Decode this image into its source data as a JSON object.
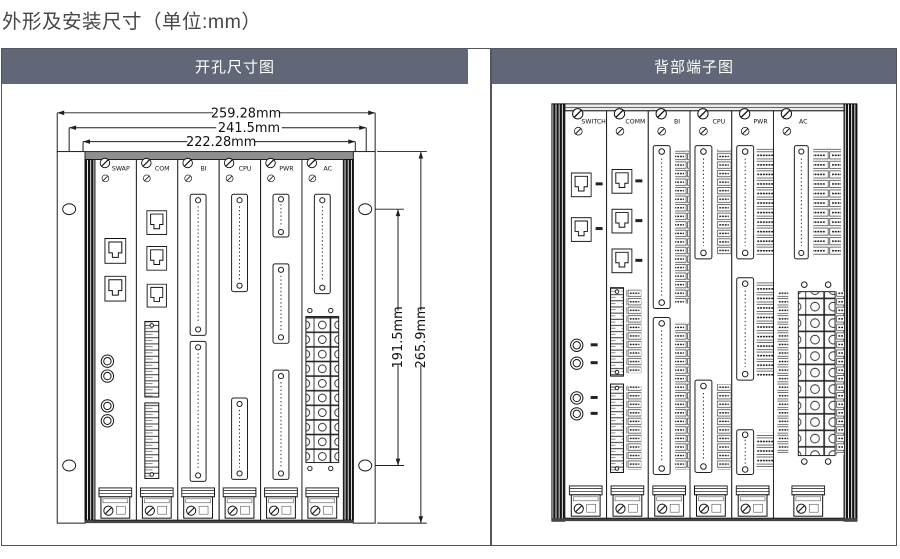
{
  "title": "外形及安装尺寸（单位:mm）",
  "panels": {
    "left": {
      "header": "开孔尺寸图",
      "modules": [
        "SWAP",
        "COM",
        "BI",
        "CPU",
        "PWR",
        "AC"
      ],
      "dims": {
        "w_outer": "259.28mm",
        "w_holes": "241.5mm",
        "w_body": "222.28mm",
        "h_holes": "191.5mm",
        "h_overall": "265.9mm"
      }
    },
    "right": {
      "header": "背部端子图",
      "modules": [
        "SWITCH",
        "COMM",
        "BI",
        "CPU",
        "PWR",
        "AC"
      ]
    }
  },
  "colors": {
    "header_bg": "#616777",
    "header_text": "#ffffff",
    "ink": "#1f1f1f"
  }
}
